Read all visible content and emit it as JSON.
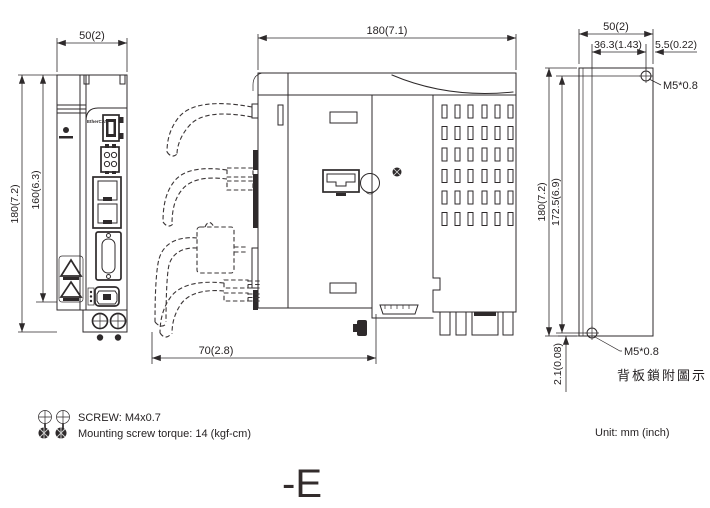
{
  "page": {
    "background": "#ffffff",
    "line_color": "#2e2a2b"
  },
  "front_view": {
    "dim_width": "50(2)",
    "dim_height_outer": "180(7.2)",
    "dim_height_inner": "160(6.3)",
    "logo": "EtherCAT"
  },
  "side_view": {
    "dim_depth": "180(7.1)",
    "dim_cable_clearance": "70(2.8)"
  },
  "back_view": {
    "dim_width": "50(2)",
    "dim_hole_offset_h": "36.3(1.43)",
    "dim_edge_offset": "5.5(0.22)",
    "dim_height_outer": "180(7.2)",
    "dim_hole_span_v": "172.5(6.9)",
    "dim_bottom_offset": "2.1(0.08)",
    "label_screw_top": "M5*0.8",
    "label_screw_bottom": "M5*0.8",
    "caption": "背板鎖附圖示"
  },
  "notes": {
    "screw_spec": "SCREW: M4x0.7",
    "torque_spec": "Mounting screw torque: 14 (kgf-cm)",
    "unit": "Unit: mm (inch)"
  },
  "footer": {
    "model_suffix": "-E"
  }
}
